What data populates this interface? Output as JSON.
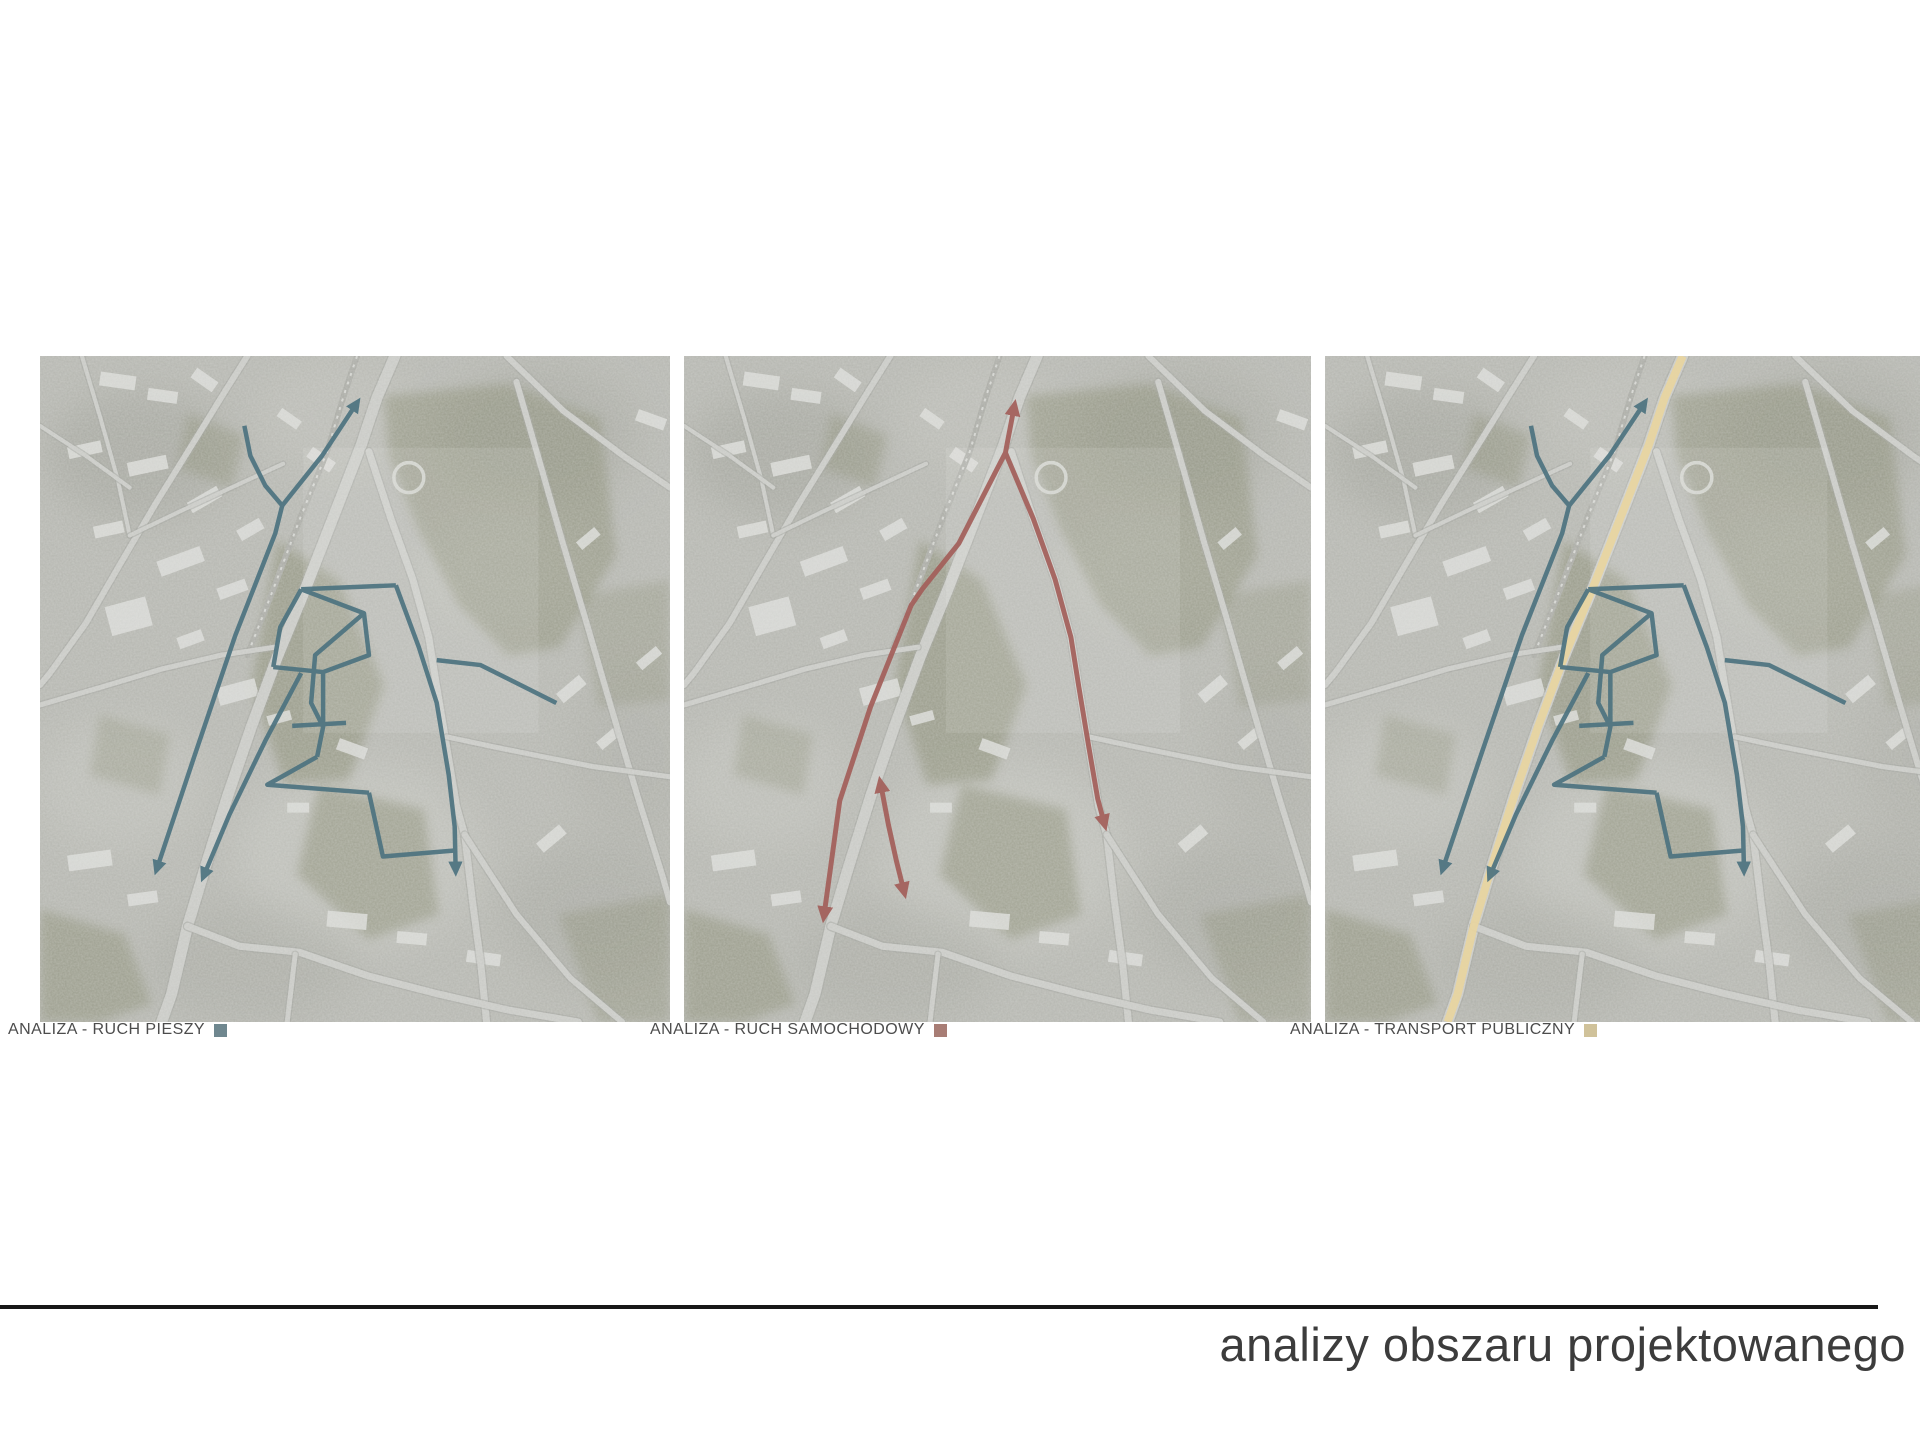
{
  "page": {
    "title": "analizy obszaru projektowanego"
  },
  "maps": [
    {
      "caption": "ANALIZA - RUCH PIESZY",
      "swatch_color": "#6f878f",
      "layers": [
        "pedestrian"
      ]
    },
    {
      "caption": "ANALIZA - RUCH SAMOCHODOWY",
      "swatch_color": "#a87d75",
      "layers": [
        "car"
      ]
    },
    {
      "caption": "ANALIZA - TRANSPORT PUBLICZNY",
      "swatch_color": "#d0c29a",
      "layers": [
        "public",
        "pedestrian"
      ]
    }
  ],
  "overlays": {
    "pedestrian": {
      "label": "ruch pieszy",
      "color": "#4d7380",
      "stroke_width": 4.5,
      "routes": [
        {
          "points": [
            [
              205,
              70
            ],
            [
              211,
              100
            ],
            [
              226,
              130
            ],
            [
              243,
              150
            ]
          ]
        },
        {
          "points": [
            [
              243,
              150
            ],
            [
              283,
              100
            ],
            [
              318,
              47
            ]
          ],
          "arrow_end": true
        },
        {
          "points": [
            [
              243,
              150
            ],
            [
              236,
              178
            ],
            [
              196,
              280
            ],
            [
              156,
              398
            ],
            [
              117,
              515
            ]
          ],
          "arrow_end": true
        },
        {
          "points": [
            [
              262,
              318
            ],
            [
              226,
              386
            ],
            [
              190,
              460
            ],
            [
              164,
              522
            ]
          ],
          "arrow_end": true
        },
        {
          "points": [
            [
              262,
              234
            ],
            [
              357,
              230
            ]
          ]
        },
        {
          "points": [
            [
              357,
              230
            ],
            [
              380,
              292
            ],
            [
              398,
              348
            ],
            [
              410,
              420
            ],
            [
              416,
              472
            ],
            [
              417,
              516
            ]
          ],
          "arrow_end": true
        },
        {
          "points": [
            [
              398,
              305
            ],
            [
              442,
              310
            ],
            [
              482,
              330
            ],
            [
              518,
              348
            ]
          ]
        },
        {
          "points": [
            [
              262,
              234
            ],
            [
              241,
              272
            ],
            [
              234,
              312
            ]
          ]
        },
        {
          "points": [
            [
              234,
              312
            ],
            [
              284,
              317
            ],
            [
              330,
              300
            ],
            [
              325,
              258
            ],
            [
              262,
              234
            ]
          ]
        },
        {
          "points": [
            [
              325,
              258
            ],
            [
              276,
              300
            ],
            [
              272,
              348
            ],
            [
              284,
              372
            ],
            [
              278,
              402
            ]
          ]
        },
        {
          "points": [
            [
              253,
              371
            ],
            [
              307,
              368
            ]
          ]
        },
        {
          "points": [
            [
              284,
              317
            ],
            [
              284,
              372
            ]
          ]
        },
        {
          "points": [
            [
              278,
              402
            ],
            [
              246,
              420
            ],
            [
              228,
              430
            ],
            [
              330,
              438
            ]
          ]
        },
        {
          "points": [
            [
              330,
              438
            ],
            [
              344,
              502
            ],
            [
              416,
              496
            ]
          ]
        }
      ]
    },
    "car": {
      "label": "ruch samochodowy",
      "color": "#a35f5a",
      "stroke_width": 5,
      "routes": [
        {
          "points": [
            [
              333,
              50
            ],
            [
              324,
              97
            ],
            [
              277,
              188
            ],
            [
              240,
              234
            ],
            [
              229,
              250
            ],
            [
              188,
              352
            ],
            [
              157,
              446
            ],
            [
              141,
              562
            ]
          ],
          "arrow_start": true,
          "arrow_end": true
        },
        {
          "points": [
            [
              324,
              97
            ],
            [
              352,
              163
            ],
            [
              374,
              224
            ],
            [
              390,
              282
            ],
            [
              398,
              332
            ],
            [
              408,
              392
            ],
            [
              417,
              444
            ],
            [
              424,
              470
            ]
          ],
          "arrow_end": true
        },
        {
          "points": [
            [
              198,
              428
            ],
            [
              206,
              470
            ],
            [
              214,
              506
            ],
            [
              222,
              538
            ]
          ],
          "arrow_start": true,
          "arrow_end": true
        }
      ]
    },
    "public": {
      "label": "transport publiczny",
      "color": "#e8d5a0",
      "stroke_width": 8,
      "routes": [
        {
          "points": [
            [
              356,
              0
            ],
            [
              338,
              42
            ],
            [
              322,
              90
            ],
            [
              298,
              152
            ],
            [
              266,
              234
            ],
            [
              238,
              302
            ],
            [
              212,
              372
            ],
            [
              188,
              442
            ],
            [
              166,
              512
            ],
            [
              148,
              572
            ],
            [
              132,
              640
            ],
            [
              122,
              668
            ]
          ]
        }
      ]
    }
  }
}
